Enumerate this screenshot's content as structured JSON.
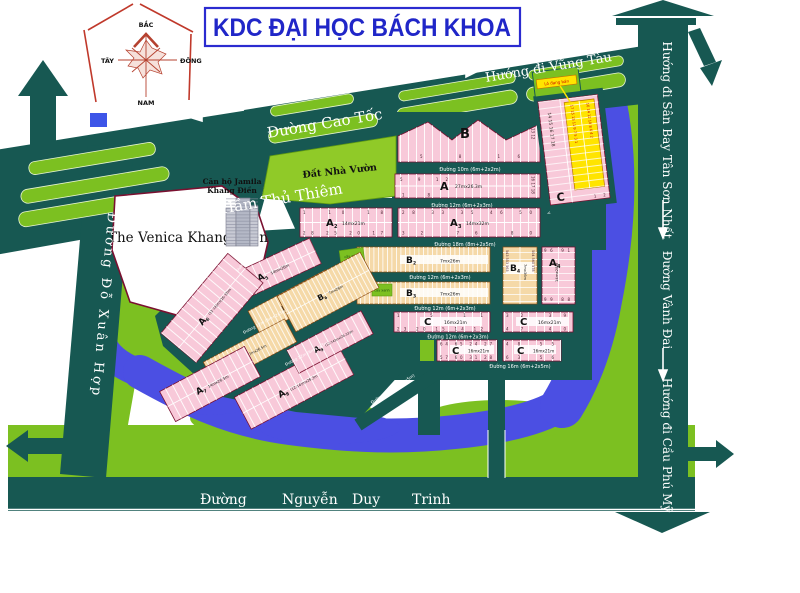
{
  "title": "KDC ĐẠI HỌC BÁCH KHOA",
  "compass": {
    "n": "BẮC",
    "s": "NAM",
    "e": "ĐÔNG",
    "w": "TÂY"
  },
  "highways": {
    "ham_thu_thiem": "Hướng đi Hầm Thủ Thiêm",
    "cao_toc": "Đường Cao Tốc",
    "vung_tau": "Hướng đi Vũng Tàu",
    "san_bay": "Hướng đi Sân Bay Tân Sơn Nhất",
    "vanh_dai": "Đường Vành Đai",
    "cau_phu_my": "Hướng đi Cầu Phú Mỹ",
    "do_xuan_hop": "Đường Đỗ Xuân Hợp",
    "nguyen_duy_trinh": {
      "w1": "Đường",
      "w2": "Nguyễn",
      "w3": "Duy",
      "w4": "Trinh"
    }
  },
  "streets": {
    "s10": "Đường 10m (6m+2x2m)",
    "s12": "Đường 12m (6m+2x3m)",
    "s16": "Đường 16m (6m+2x5m)",
    "s18": "Đường 18m (8m+2x5m)"
  },
  "places": {
    "venica": "The Venica Khang Điền",
    "jamila_l1": "Căn hộ Jamila",
    "jamila_l2": "Khang Điền",
    "dat_nha_vuon": "Đất Nhà Vườn",
    "cay_xanh": "cây xanh",
    "sale_tag": "Lô đang bán"
  },
  "blocks": {
    "b_top": {
      "letter": "B",
      "plots_side": [
        13,
        12
      ],
      "plots_bottom": [
        5,
        8,
        16
      ]
    },
    "a1": {
      "letter": "A",
      "dims": "27mx26.3m",
      "plots_top": [
        5,
        9,
        12
      ],
      "plots_right": [
        16,
        17,
        18
      ],
      "plots_bottom": [
        1,
        8
      ]
    },
    "c_strip": {
      "letter": "C",
      "pink_plots": [
        14,
        15,
        16,
        17,
        18
      ],
      "yellow_left": [
        17,
        15,
        13,
        11,
        9,
        7,
        5,
        3,
        1
      ],
      "yellow_right": [
        16,
        14,
        12,
        10,
        8,
        6,
        4,
        2
      ],
      "corner": [
        1,
        2
      ]
    },
    "a2": {
      "letter": "A",
      "sub": "2",
      "dims": "14mx21m",
      "plots_top": [
        1,
        10,
        18
      ],
      "plots_bottom": [
        28,
        25,
        20,
        17
      ]
    },
    "a3": {
      "letter": "A",
      "sub": "3",
      "dims": "14mx32m",
      "plots_top": [
        28,
        33,
        35,
        46,
        50
      ],
      "plots_bottom": [
        32,
        76,
        80
      ]
    },
    "b2": {
      "letter": "B",
      "sub": "2",
      "dims": "7mx26m"
    },
    "b3": {
      "letter": "B",
      "sub": "3",
      "dims": "7mx26m"
    },
    "b4": {
      "letter": "B",
      "sub": "4",
      "dims": "7mx36m",
      "plots_left": [
        543,
        553,
        563
      ],
      "plots_right": [
        504,
        560,
        578
      ]
    },
    "a_r": {
      "letter": "A",
      "sub": "4",
      "dims": "14mx28m",
      "plots_top": [
        96,
        91
      ],
      "plots_bottom": [
        99,
        88
      ]
    },
    "c1": {
      "letter": "C",
      "dims": "16mx21m",
      "plots_top": [
        1,
        5,
        11
      ],
      "plots_bottom": [
        23,
        20,
        15,
        14,
        12
      ]
    },
    "c2": {
      "letter": "C",
      "dims": "16mx21m",
      "plots_top": [
        32,
        39
      ],
      "plots_bottom": [
        47,
        40
      ]
    },
    "c3": {
      "letter": "C",
      "dims": "16mx21m",
      "plots_top": [
        64,
        65,
        24,
        27
      ],
      "plots_bottom": [
        57,
        60,
        31,
        28
      ]
    },
    "c4": {
      "letter": "C",
      "dims": "16mx21m",
      "plots_top": [
        48,
        55
      ],
      "plots_bottom": [
        63,
        56
      ]
    },
    "a5": {
      "letter": "A",
      "sub": "5",
      "dims": "14mx26m"
    },
    "a6": {
      "letter": "A",
      "sub": "6",
      "dims": "(12-14)mx(26-33)m"
    },
    "b5": {
      "letter": "B",
      "sub": "5",
      "dims": "7mx26m"
    },
    "b6": {
      "letter": "B",
      "sub": "6",
      "dims": "7mx26m"
    },
    "b7": {
      "letter": "B",
      "sub": "7",
      "dims": "7mx26.5m"
    },
    "a7": {
      "letter": "A",
      "sub": "7",
      "dims": "14mx26.5m"
    },
    "a8": {
      "letter": "A",
      "sub": "8",
      "dims": "(12-14)mx26.3m"
    },
    "a9": {
      "letter": "A",
      "sub": "9",
      "dims": "(12-14)mx(26-33)m"
    }
  },
  "colors": {
    "road": "#175852",
    "lime": "#7cc021",
    "river": "#4b4fe3",
    "pink": "#f8c9d9",
    "tan": "#f5d9a8",
    "yellow": "#ffe400",
    "maroon": "#7a1030",
    "title_blue": "#2026c8"
  }
}
